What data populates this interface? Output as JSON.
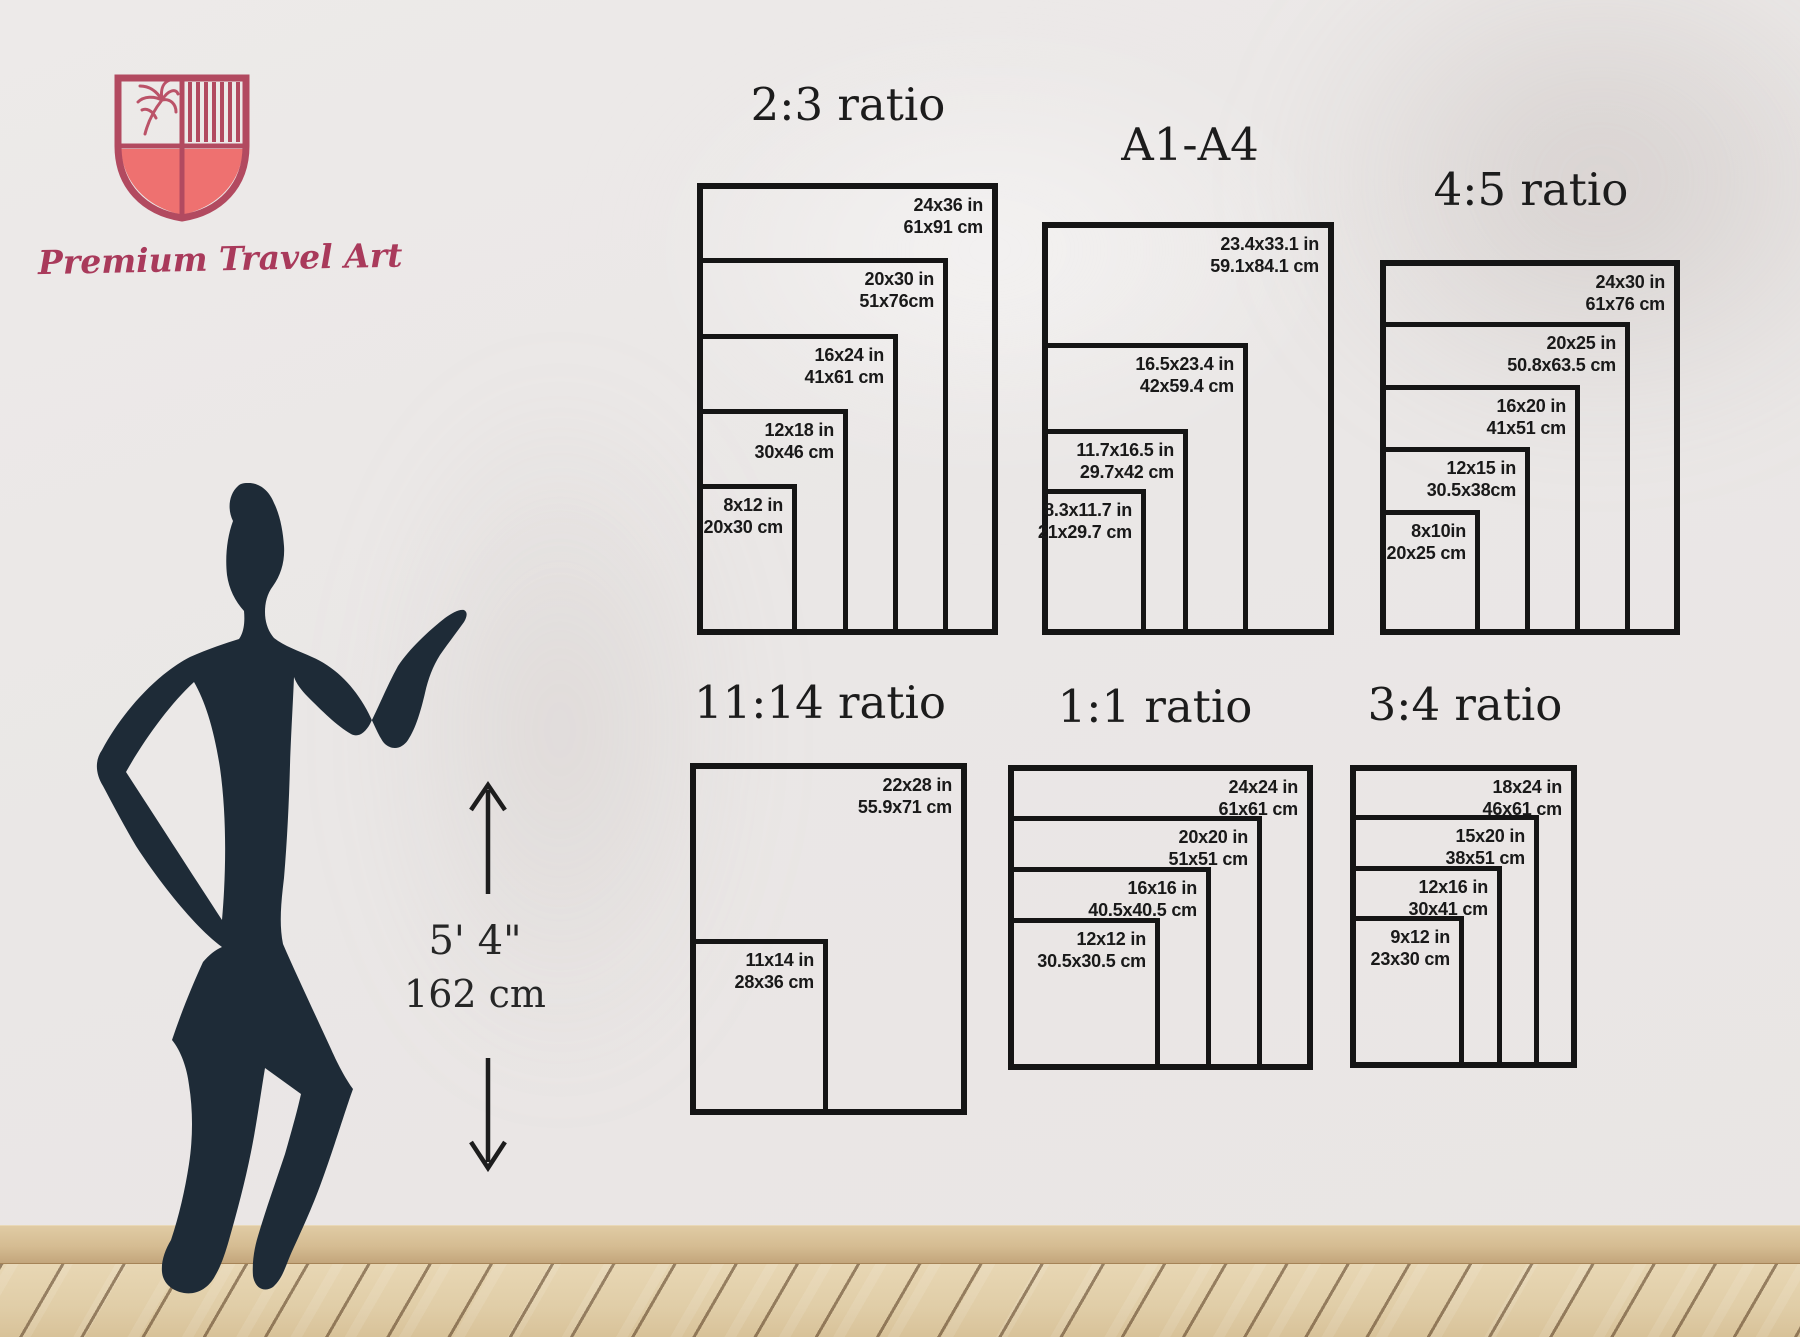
{
  "logo": {
    "brand": "Premium Travel Art",
    "accent": "#b24a60",
    "shield_fill": "#ee7170",
    "text_color": "#a93a5b"
  },
  "height_indicator": {
    "feet": "5' 4\"",
    "cm": "162 cm"
  },
  "silhouette": {
    "color": "#1e2b37"
  },
  "wall_color": "#ebe8e7",
  "charts": [
    {
      "id": "ratio-2-3",
      "title": "2:3 ratio",
      "title_x": 848,
      "title_y": 78,
      "left": 697,
      "bottom": 635,
      "scale": 12.55,
      "sizes": [
        {
          "in": "24x36 in",
          "cm": "61x91 cm",
          "w": 24,
          "h": 36
        },
        {
          "in": "20x30 in",
          "cm": "51x76cm",
          "w": 20,
          "h": 30
        },
        {
          "in": "16x24 in",
          "cm": "41x61 cm",
          "w": 16,
          "h": 24
        },
        {
          "in": "12x18 in",
          "cm": "30x46 cm",
          "w": 12,
          "h": 18
        },
        {
          "in": "8x12 in",
          "cm": "20x30 cm",
          "w": 8,
          "h": 12
        }
      ]
    },
    {
      "id": "a1-a4",
      "title": "A1-A4",
      "title_x": 1190,
      "title_y": 118,
      "left": 1042,
      "bottom": 635,
      "scale": 12.48,
      "sizes": [
        {
          "in": "23.4x33.1 in",
          "cm": "59.1x84.1 cm",
          "w": 23.4,
          "h": 33.1
        },
        {
          "in": "16.5x23.4 in",
          "cm": "42x59.4 cm",
          "w": 16.5,
          "h": 23.4
        },
        {
          "in": "11.7x16.5 in",
          "cm": "29.7x42 cm",
          "w": 11.7,
          "h": 16.5
        },
        {
          "in": "8.3x11.7 in",
          "cm": "21x29.7 cm",
          "w": 8.3,
          "h": 11.7
        }
      ]
    },
    {
      "id": "ratio-4-5",
      "title": "4:5 ratio",
      "title_x": 1531,
      "title_y": 163,
      "left": 1380,
      "bottom": 635,
      "scale": 12.5,
      "sizes": [
        {
          "in": "24x30 in",
          "cm": "61x76 cm",
          "w": 24,
          "h": 30
        },
        {
          "in": "20x25 in",
          "cm": "50.8x63.5 cm",
          "w": 20,
          "h": 25
        },
        {
          "in": "16x20 in",
          "cm": "41x51 cm",
          "w": 16,
          "h": 20
        },
        {
          "in": "12x15 in",
          "cm": "30.5x38cm",
          "w": 12,
          "h": 15
        },
        {
          "in": "8x10in",
          "cm": "20x25 cm",
          "w": 8,
          "h": 10
        }
      ]
    },
    {
      "id": "ratio-11-14",
      "title": "11:14 ratio",
      "title_x": 820,
      "title_y": 676,
      "left": 690,
      "bottom": 1115,
      "scale": 12.57,
      "sizes": [
        {
          "in": "22x28 in",
          "cm": "55.9x71 cm",
          "w": 22,
          "h": 28
        },
        {
          "in": "11x14 in",
          "cm": "28x36 cm",
          "w": 11,
          "h": 14
        }
      ]
    },
    {
      "id": "ratio-1-1",
      "title": "1:1 ratio",
      "title_x": 1155,
      "title_y": 680,
      "left": 1008,
      "bottom": 1070,
      "scale": 12.7,
      "sizes": [
        {
          "in": "24x24 in",
          "cm": "61x61 cm",
          "w": 24,
          "h": 24
        },
        {
          "in": "20x20 in",
          "cm": "51x51 cm",
          "w": 20,
          "h": 20
        },
        {
          "in": "16x16 in",
          "cm": "40.5x40.5 cm",
          "w": 16,
          "h": 16
        },
        {
          "in": "12x12 in",
          "cm": "30.5x30.5 cm",
          "w": 12,
          "h": 12
        }
      ]
    },
    {
      "id": "ratio-3-4",
      "title": "3:4 ratio",
      "title_x": 1465,
      "title_y": 678,
      "left": 1350,
      "bottom": 1068,
      "scale": 12.63,
      "sizes": [
        {
          "in": "18x24 in",
          "cm": "46x61 cm",
          "w": 18,
          "h": 24
        },
        {
          "in": "15x20 in",
          "cm": "38x51 cm",
          "w": 15,
          "h": 20
        },
        {
          "in": "12x16 in",
          "cm": "30x41 cm",
          "w": 12,
          "h": 16
        },
        {
          "in": "9x12 in",
          "cm": "23x30 cm",
          "w": 9,
          "h": 12
        }
      ]
    }
  ]
}
